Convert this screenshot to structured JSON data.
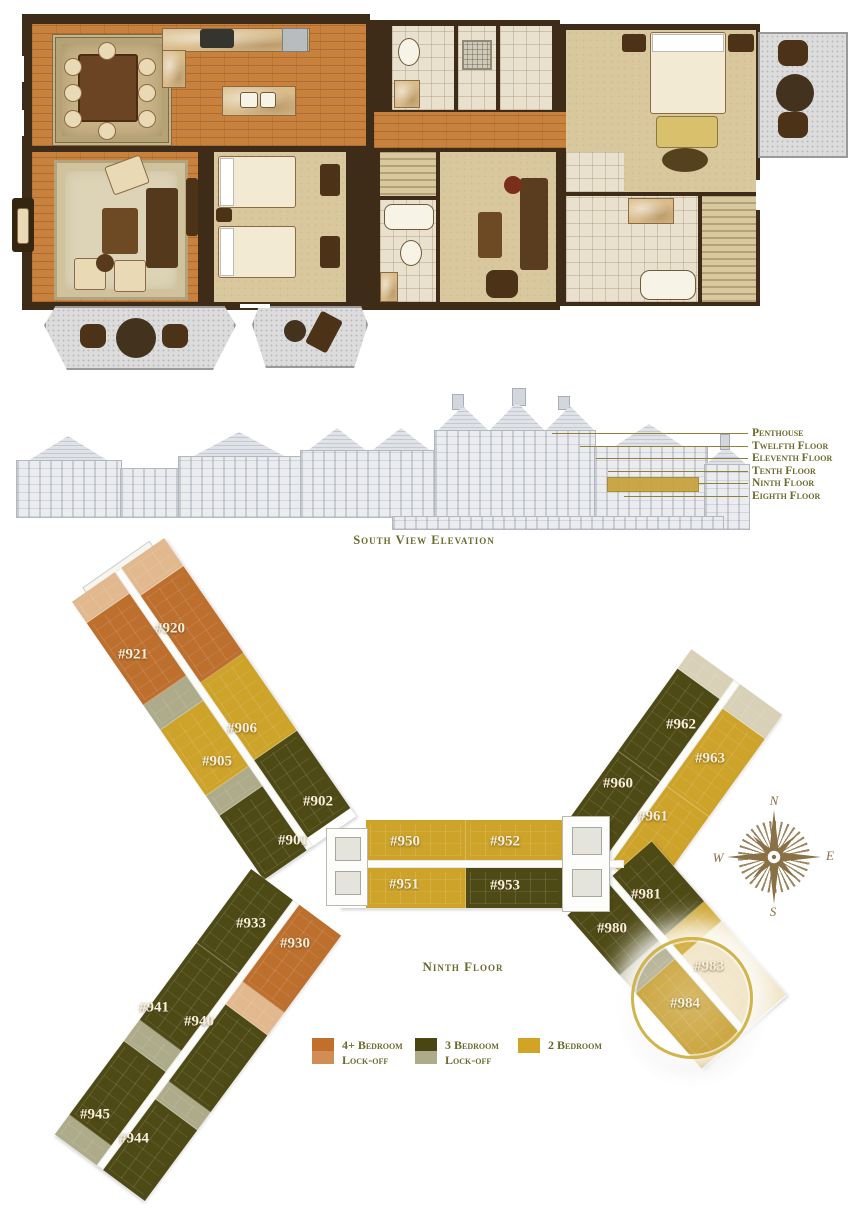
{
  "elevation": {
    "caption": "South View Elevation",
    "floor_labels": [
      "Penthouse",
      "Twelfth Floor",
      "Eleventh Floor",
      "Tenth Floor",
      "Ninth Floor",
      "Eighth Floor"
    ],
    "highlight_color": "#c7a23a"
  },
  "key_plan": {
    "title": "Ninth Floor",
    "compass": {
      "north": "N",
      "east": "E",
      "south": "S",
      "west": "W"
    },
    "legend": [
      {
        "line1": "4+ Bedroom",
        "line2": "Lock-off",
        "swatch_top": "#c0702b",
        "swatch_bottom": "#d08d55"
      },
      {
        "line1": "3 Bedroom",
        "line2": "Lock-off",
        "swatch_top": "#4a4512",
        "swatch_bottom": "#aeab8a"
      },
      {
        "line1": "2 Bedroom",
        "line2": "",
        "swatch_top": "#d2a426",
        "swatch_bottom": "#d2a426"
      }
    ],
    "highlighted_units": [
      "#983",
      "#984"
    ],
    "units": [
      {
        "id": "#920",
        "type": "4plus-bedroom",
        "x": 170,
        "y": 629
      },
      {
        "id": "#921",
        "type": "4plus-bedroom",
        "x": 133,
        "y": 655
      },
      {
        "id": "#906",
        "type": "2-bedroom",
        "x": 242,
        "y": 729
      },
      {
        "id": "#905",
        "type": "2-bedroom",
        "x": 217,
        "y": 762
      },
      {
        "id": "#902",
        "type": "3-bedroom",
        "x": 318,
        "y": 802
      },
      {
        "id": "#901",
        "type": "3-bedroom",
        "x": 293,
        "y": 841
      },
      {
        "id": "#950",
        "type": "2-bedroom",
        "x": 405,
        "y": 842
      },
      {
        "id": "#952",
        "type": "2-bedroom",
        "x": 505,
        "y": 842
      },
      {
        "id": "#951",
        "type": "2-bedroom",
        "x": 404,
        "y": 885
      },
      {
        "id": "#953",
        "type": "3-bedroom",
        "x": 505,
        "y": 886
      },
      {
        "id": "#962",
        "type": "3-bedroom",
        "x": 681,
        "y": 725
      },
      {
        "id": "#963",
        "type": "2-bedroom",
        "x": 710,
        "y": 759
      },
      {
        "id": "#960",
        "type": "3-bedroom",
        "x": 618,
        "y": 784
      },
      {
        "id": "#961",
        "type": "2-bedroom",
        "x": 653,
        "y": 817
      },
      {
        "id": "#981",
        "type": "3-bedroom",
        "x": 646,
        "y": 895
      },
      {
        "id": "#980",
        "type": "3-bedroom",
        "x": 612,
        "y": 929
      },
      {
        "id": "#983",
        "type": "2-bedroom",
        "x": 709,
        "y": 967,
        "highlighted": true
      },
      {
        "id": "#984",
        "type": "2-bedroom",
        "x": 685,
        "y": 1004,
        "highlighted": true
      },
      {
        "id": "#933",
        "type": "3-bedroom",
        "x": 251,
        "y": 924
      },
      {
        "id": "#930",
        "type": "4plus-bedroom",
        "x": 295,
        "y": 944
      },
      {
        "id": "#941",
        "type": "3-bedroom",
        "x": 154,
        "y": 1008
      },
      {
        "id": "#940",
        "type": "3-bedroom",
        "x": 199,
        "y": 1022
      },
      {
        "id": "#945",
        "type": "3-bedroom",
        "x": 95,
        "y": 1115
      },
      {
        "id": "#944",
        "type": "3-bedroom",
        "x": 134,
        "y": 1139
      }
    ],
    "colors": {
      "four_bedroom": "#c0702b",
      "four_bedroom_lockoff": "#d08d55",
      "four_bedroom_cap": "#e2b98e",
      "three_bedroom": "#4e4a16",
      "three_bedroom_lockoff": "#aeab8a",
      "two_bedroom": "#cda32a",
      "highlight_ring": "#d2b44c"
    }
  }
}
